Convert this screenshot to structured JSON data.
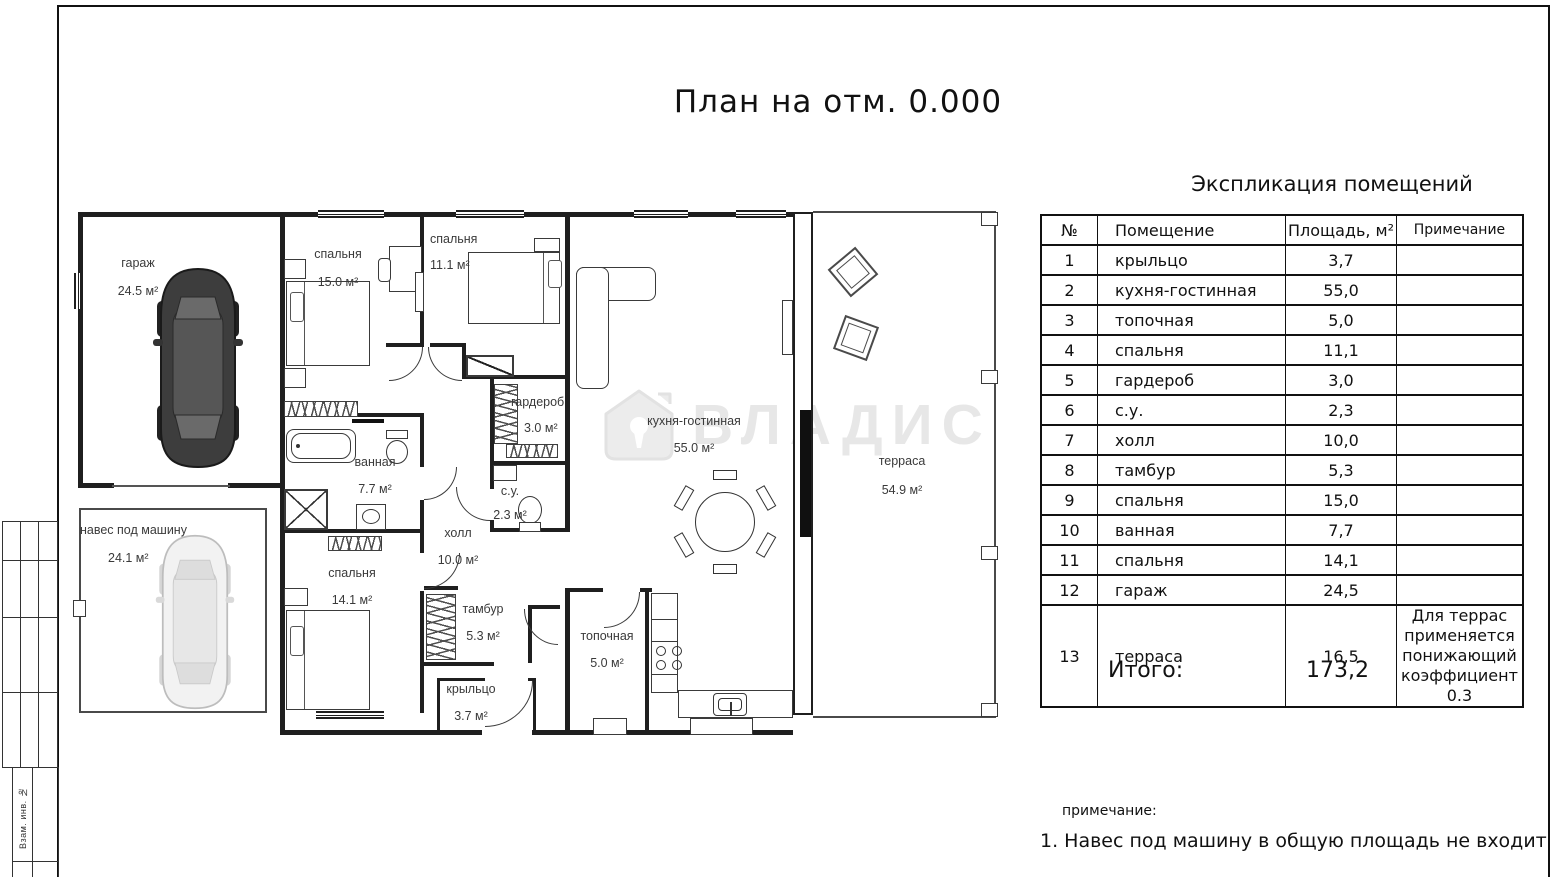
{
  "sheet": {
    "title": "План на отм. 0.000"
  },
  "watermark": {
    "text": "ВЛАДИС"
  },
  "stamp": {
    "vertical_label": "Взам. инв. №"
  },
  "plan": {
    "rooms": [
      {
        "name": "гараж",
        "area": "24.5 м²"
      },
      {
        "name": "навес под машину",
        "area": "24.1 м²"
      },
      {
        "name": "спальня",
        "area": "15.0 м²"
      },
      {
        "name": "спальня",
        "area": "11.1 м²"
      },
      {
        "name": "гардероб",
        "area": "3.0 м²"
      },
      {
        "name": "ванная",
        "area": "7.7 м²"
      },
      {
        "name": "с.у.",
        "area": "2.3 м²"
      },
      {
        "name": "холл",
        "area": "10.0 м²"
      },
      {
        "name": "спальня",
        "area": "14.1 м²"
      },
      {
        "name": "тамбур",
        "area": "5.3 м²"
      },
      {
        "name": "крыльцо",
        "area": "3.7 м²"
      },
      {
        "name": "топочная",
        "area": "5.0 м²"
      },
      {
        "name": "кухня-гостинная",
        "area": "55.0 м²"
      },
      {
        "name": "терраса",
        "area": "54.9 м²"
      }
    ]
  },
  "explication": {
    "title": "Экспликация помещений",
    "columns": {
      "num": "№",
      "room": "Помещение",
      "area": "Площадь, м²",
      "note": "Примечание"
    },
    "rows": [
      {
        "num": "1",
        "room": "крыльцо",
        "area": "3,7",
        "note": ""
      },
      {
        "num": "2",
        "room": "кухня-гостинная",
        "area": "55,0",
        "note": ""
      },
      {
        "num": "3",
        "room": "топочная",
        "area": "5,0",
        "note": ""
      },
      {
        "num": "4",
        "room": "спальня",
        "area": "11,1",
        "note": ""
      },
      {
        "num": "5",
        "room": "гардероб",
        "area": "3,0",
        "note": ""
      },
      {
        "num": "6",
        "room": "с.у.",
        "area": "2,3",
        "note": ""
      },
      {
        "num": "7",
        "room": "холл",
        "area": "10,0",
        "note": ""
      },
      {
        "num": "8",
        "room": "тамбур",
        "area": "5,3",
        "note": ""
      },
      {
        "num": "9",
        "room": "спальня",
        "area": "15,0",
        "note": ""
      },
      {
        "num": "10",
        "room": "ванная",
        "area": "7,7",
        "note": ""
      },
      {
        "num": "11",
        "room": "спальня",
        "area": "14,1",
        "note": ""
      },
      {
        "num": "12",
        "room": "гараж",
        "area": "24,5",
        "note": ""
      },
      {
        "num": "13",
        "room": "терраса",
        "area": "16,5",
        "note": "Для террас применяется понижающий коэффициент 0.3"
      }
    ],
    "total_label": "Итого:",
    "total_value": "173,2"
  },
  "notes": {
    "label": "примечание:",
    "line1": "1. Навес под машину в общую площадь не входит"
  }
}
